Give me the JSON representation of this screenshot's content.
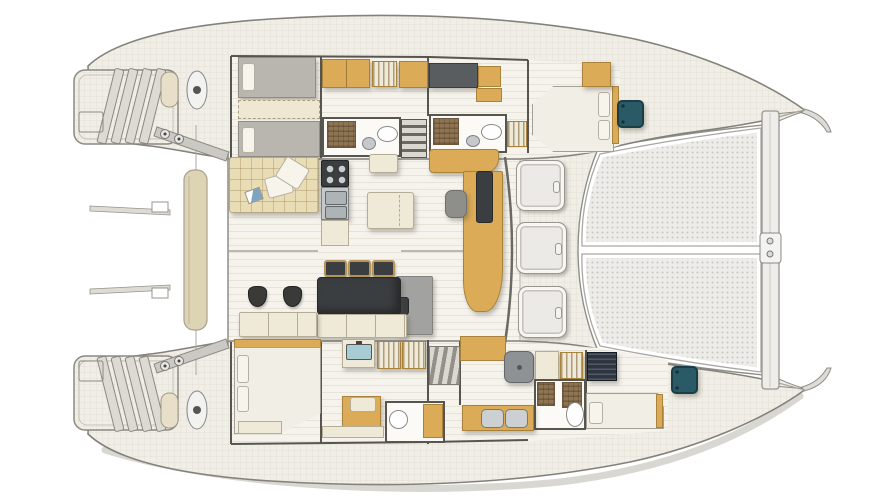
{
  "meta": {
    "title": "Catamaran yacht floor plan",
    "view": "overhead deck and interior arrangement, bow to the right",
    "visible_text": "none"
  },
  "palette": {
    "deck": "#f0eee6",
    "deckline": "#e1ded2",
    "plank": "#f5f3ec",
    "plankline": "#e6e3d9",
    "hullline": "#83817a",
    "wall": "#57554f",
    "wood": "#dcab57",
    "woodDk": "#a9823c",
    "cream": "#efe9d8",
    "creamDk": "#b6ad96",
    "bedgray": "#b9b6af",
    "bedwhite": "#f1eee5",
    "pillow": "#f7f4ec",
    "sofa": "#e9ddb6",
    "dark": "#3b3e40",
    "gray": "#a2a2a0",
    "teal": "#2a5a66",
    "navy": "#2d3540",
    "steel": "#c6c9cb",
    "steelDk": "#868a8d",
    "brown": "#8d7452",
    "bath": "#fbfaf6",
    "tramp": "#edece9",
    "trampdot": "#c9c7c2",
    "benchtan": "#ddd4b4",
    "shadowc": "rgba(80,74,62,0.35)"
  },
  "inventory": {
    "port_hull": [
      "aft swim platform with steps",
      "transom locker door",
      "mooring cleat",
      "winch",
      "twin single berths",
      "convertible berth filler",
      "wardrobe and louvered lockers",
      "shower room with WC and basin",
      "companionway stairs",
      "forward shower room with WC and basin",
      "forward double berth cabin",
      "teal deck hatch"
    ],
    "saloon": [
      "L settee with scatter cushions",
      "galley island with 4-burner hob, twin sinks and counter",
      "side table",
      "coffee table",
      "navigation desk with instrument panel and helm seat",
      "curved wood settee"
    ],
    "cockpit": [
      "dining table",
      "three bar stools",
      "two round stools",
      "bench seating",
      "sun platform",
      "wet bar sink",
      "louvered lockers"
    ],
    "starboard_hull": [
      "aft double berth cabin",
      "vanity desk with seat",
      "aft WC compartment",
      "companionway stairs",
      "shower cubicle",
      "hanging wardrobe",
      "forward WC with twin basins",
      "forward double berth",
      "teal deck hatch",
      "aft swim platform with steps"
    ],
    "foredeck": [
      "three deck hatches",
      "split bow trampoline",
      "forward crossbeam with fitting"
    ],
    "aft_deck": [
      "aft crossbeam bench",
      "support arms with bolts",
      "davit spikes"
    ]
  }
}
